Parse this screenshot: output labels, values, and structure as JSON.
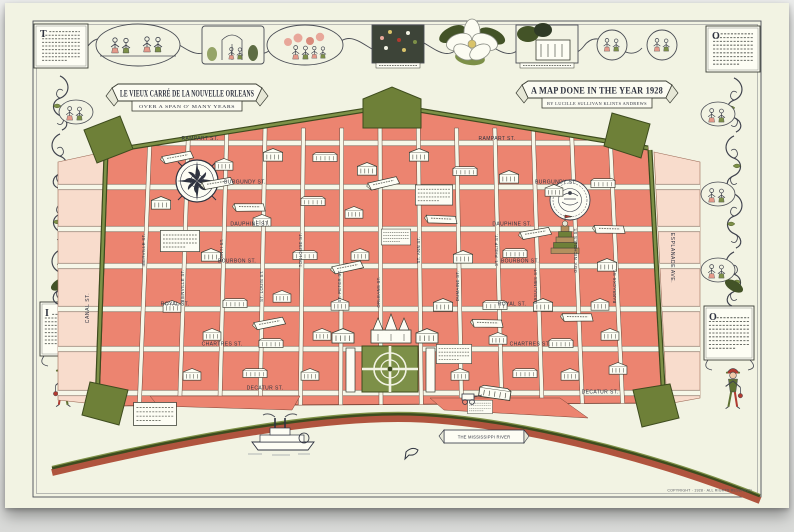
{
  "banners": {
    "left": {
      "line1": "LE VIEUX CARRÉ DE LA NOUVELLE ORLEANS",
      "line2": "OVER A SPAN O' MANY YEARS"
    },
    "right": {
      "line1": "A MAP DONE IN THE YEAR 1928",
      "line2": "BY LUCILLE SULLIVAN KLINTS ANDREWS"
    }
  },
  "corners": {
    "top_left_initial": "T",
    "top_right_initial": "O",
    "bottom_left_initial": "I",
    "bottom_right_initial": "O"
  },
  "streets": {
    "horizontal": [
      "RAMPART ST.",
      "BURGUNDY ST.",
      "DAUPHINE ST.",
      "BOURBON ST.",
      "ROYAL ST.",
      "CHARTRES ST.",
      "DECATUR ST."
    ],
    "vertical": [
      "IBERVILLE ST.",
      "BIENVILLE ST.",
      "CONTI ST.",
      "ST. LOUIS ST.",
      "TOULOUSE ST.",
      "ST. PETER ST.",
      "ORLEANS ST.",
      "ST. ANN ST.",
      "DUMAINE ST.",
      "ST. PHILIP ST.",
      "URSULINES ST.",
      "GOV. NICHOLLS ST.",
      "BARRACKS ST."
    ],
    "left_edge": "CANAL ST.",
    "right_edge": "ESPLANADE AVE."
  },
  "river": {
    "banner": "THE MISSISSIPPI RIVER"
  },
  "footer": {
    "copyright": "COPYRIGHT · 1928 · ALL RIGHTS RESERVED"
  },
  "colors": {
    "paper": "#f2f3e3",
    "block": "#ec8470",
    "block_light": "#f8dccc",
    "wall_dark": "#3e4c1e",
    "wall_light": "#7e9147",
    "bastion": "#6e8038",
    "ink": "#2f3340",
    "river_band": "#b0543e",
    "square_green": "#7d9048"
  }
}
